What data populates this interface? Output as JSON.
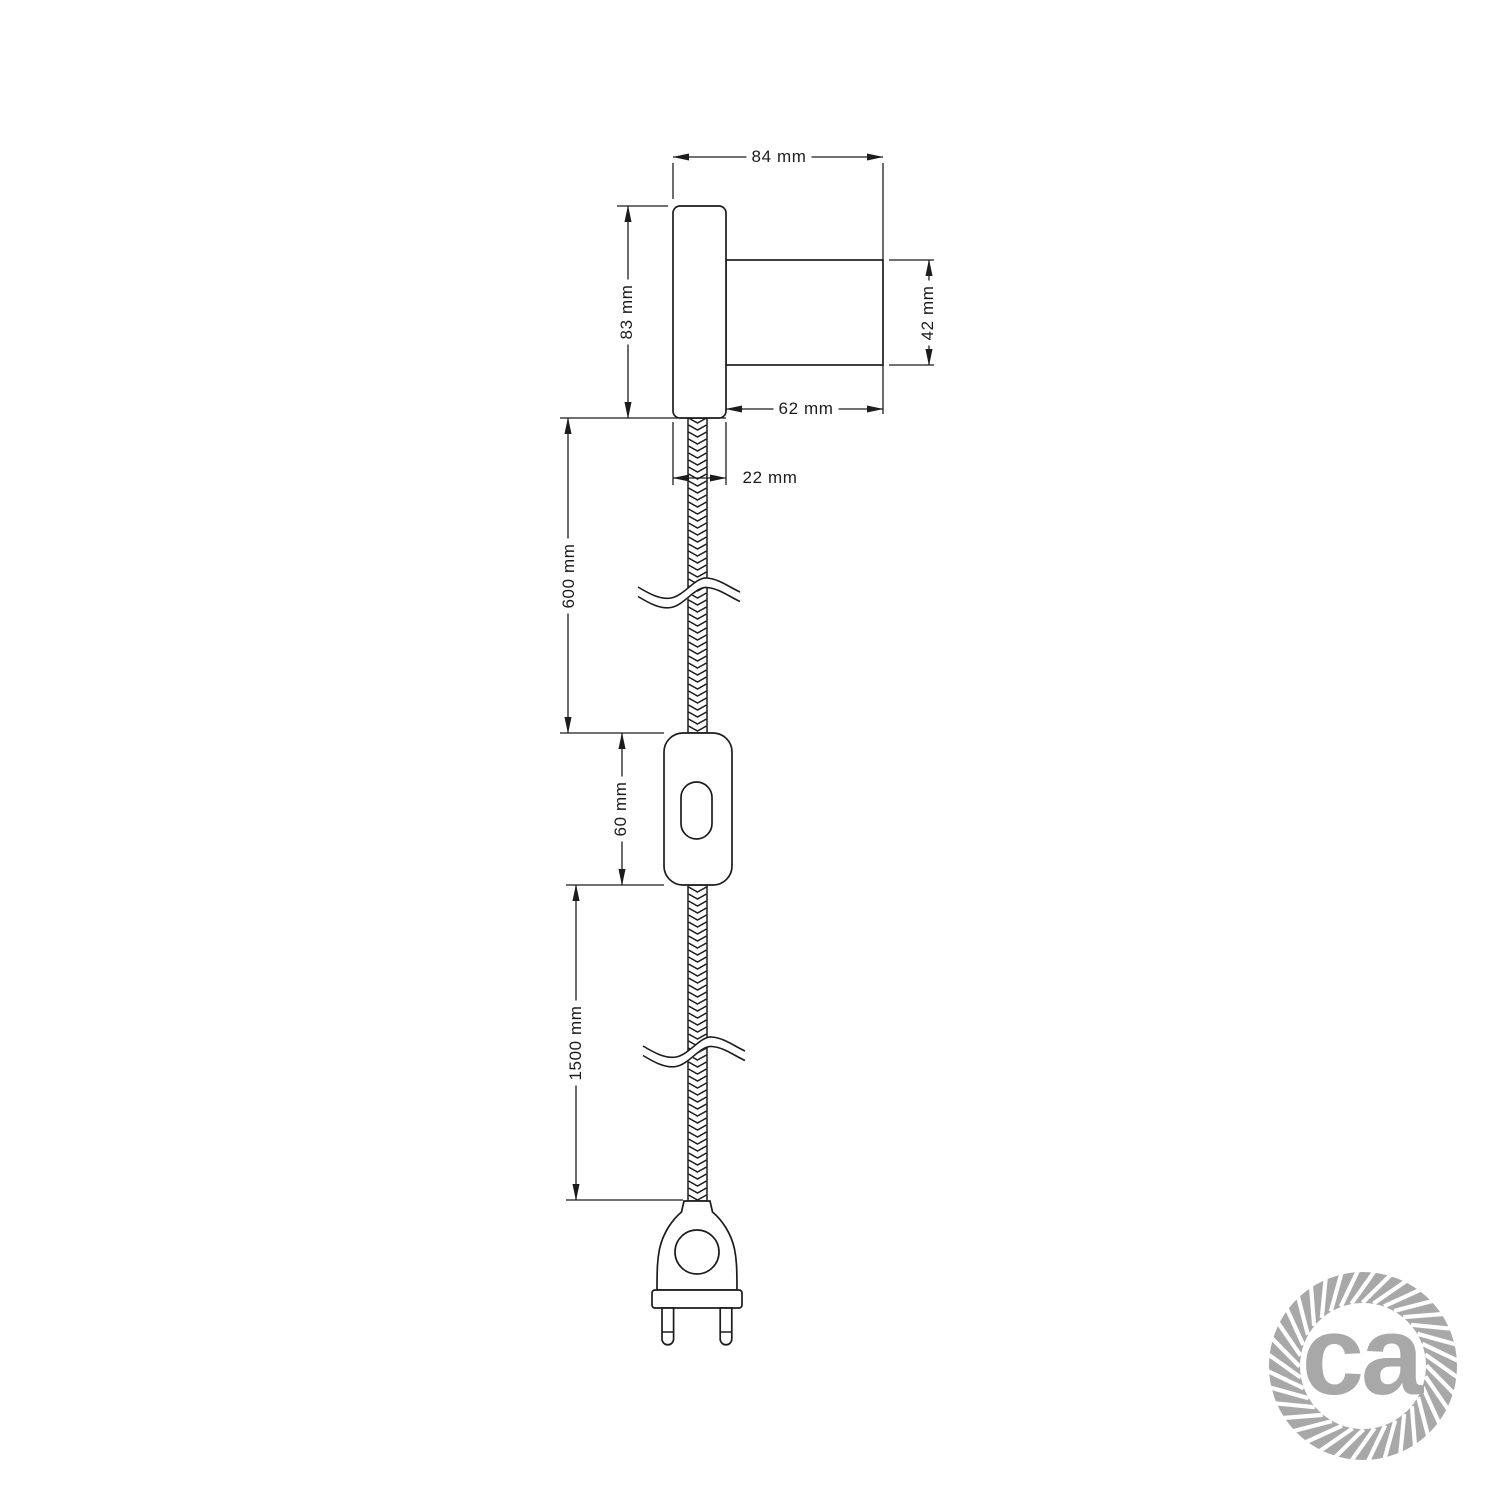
{
  "page": {
    "background": "#ffffff",
    "type": "technical-dimension-drawing"
  },
  "colors": {
    "line": "#1c1c1c",
    "logo_gray": "#a8a8a8"
  },
  "dimension_labels": {
    "total_width": "84 mm",
    "plate_height": "83 mm",
    "socket_diameter": "42 mm",
    "socket_length": "62 mm",
    "plate_depth": "22 mm",
    "upper_cable_length": "600 mm",
    "switch_length": "60 mm",
    "lower_cable_length": "1500 mm"
  },
  "logo": {
    "text": "ca"
  }
}
